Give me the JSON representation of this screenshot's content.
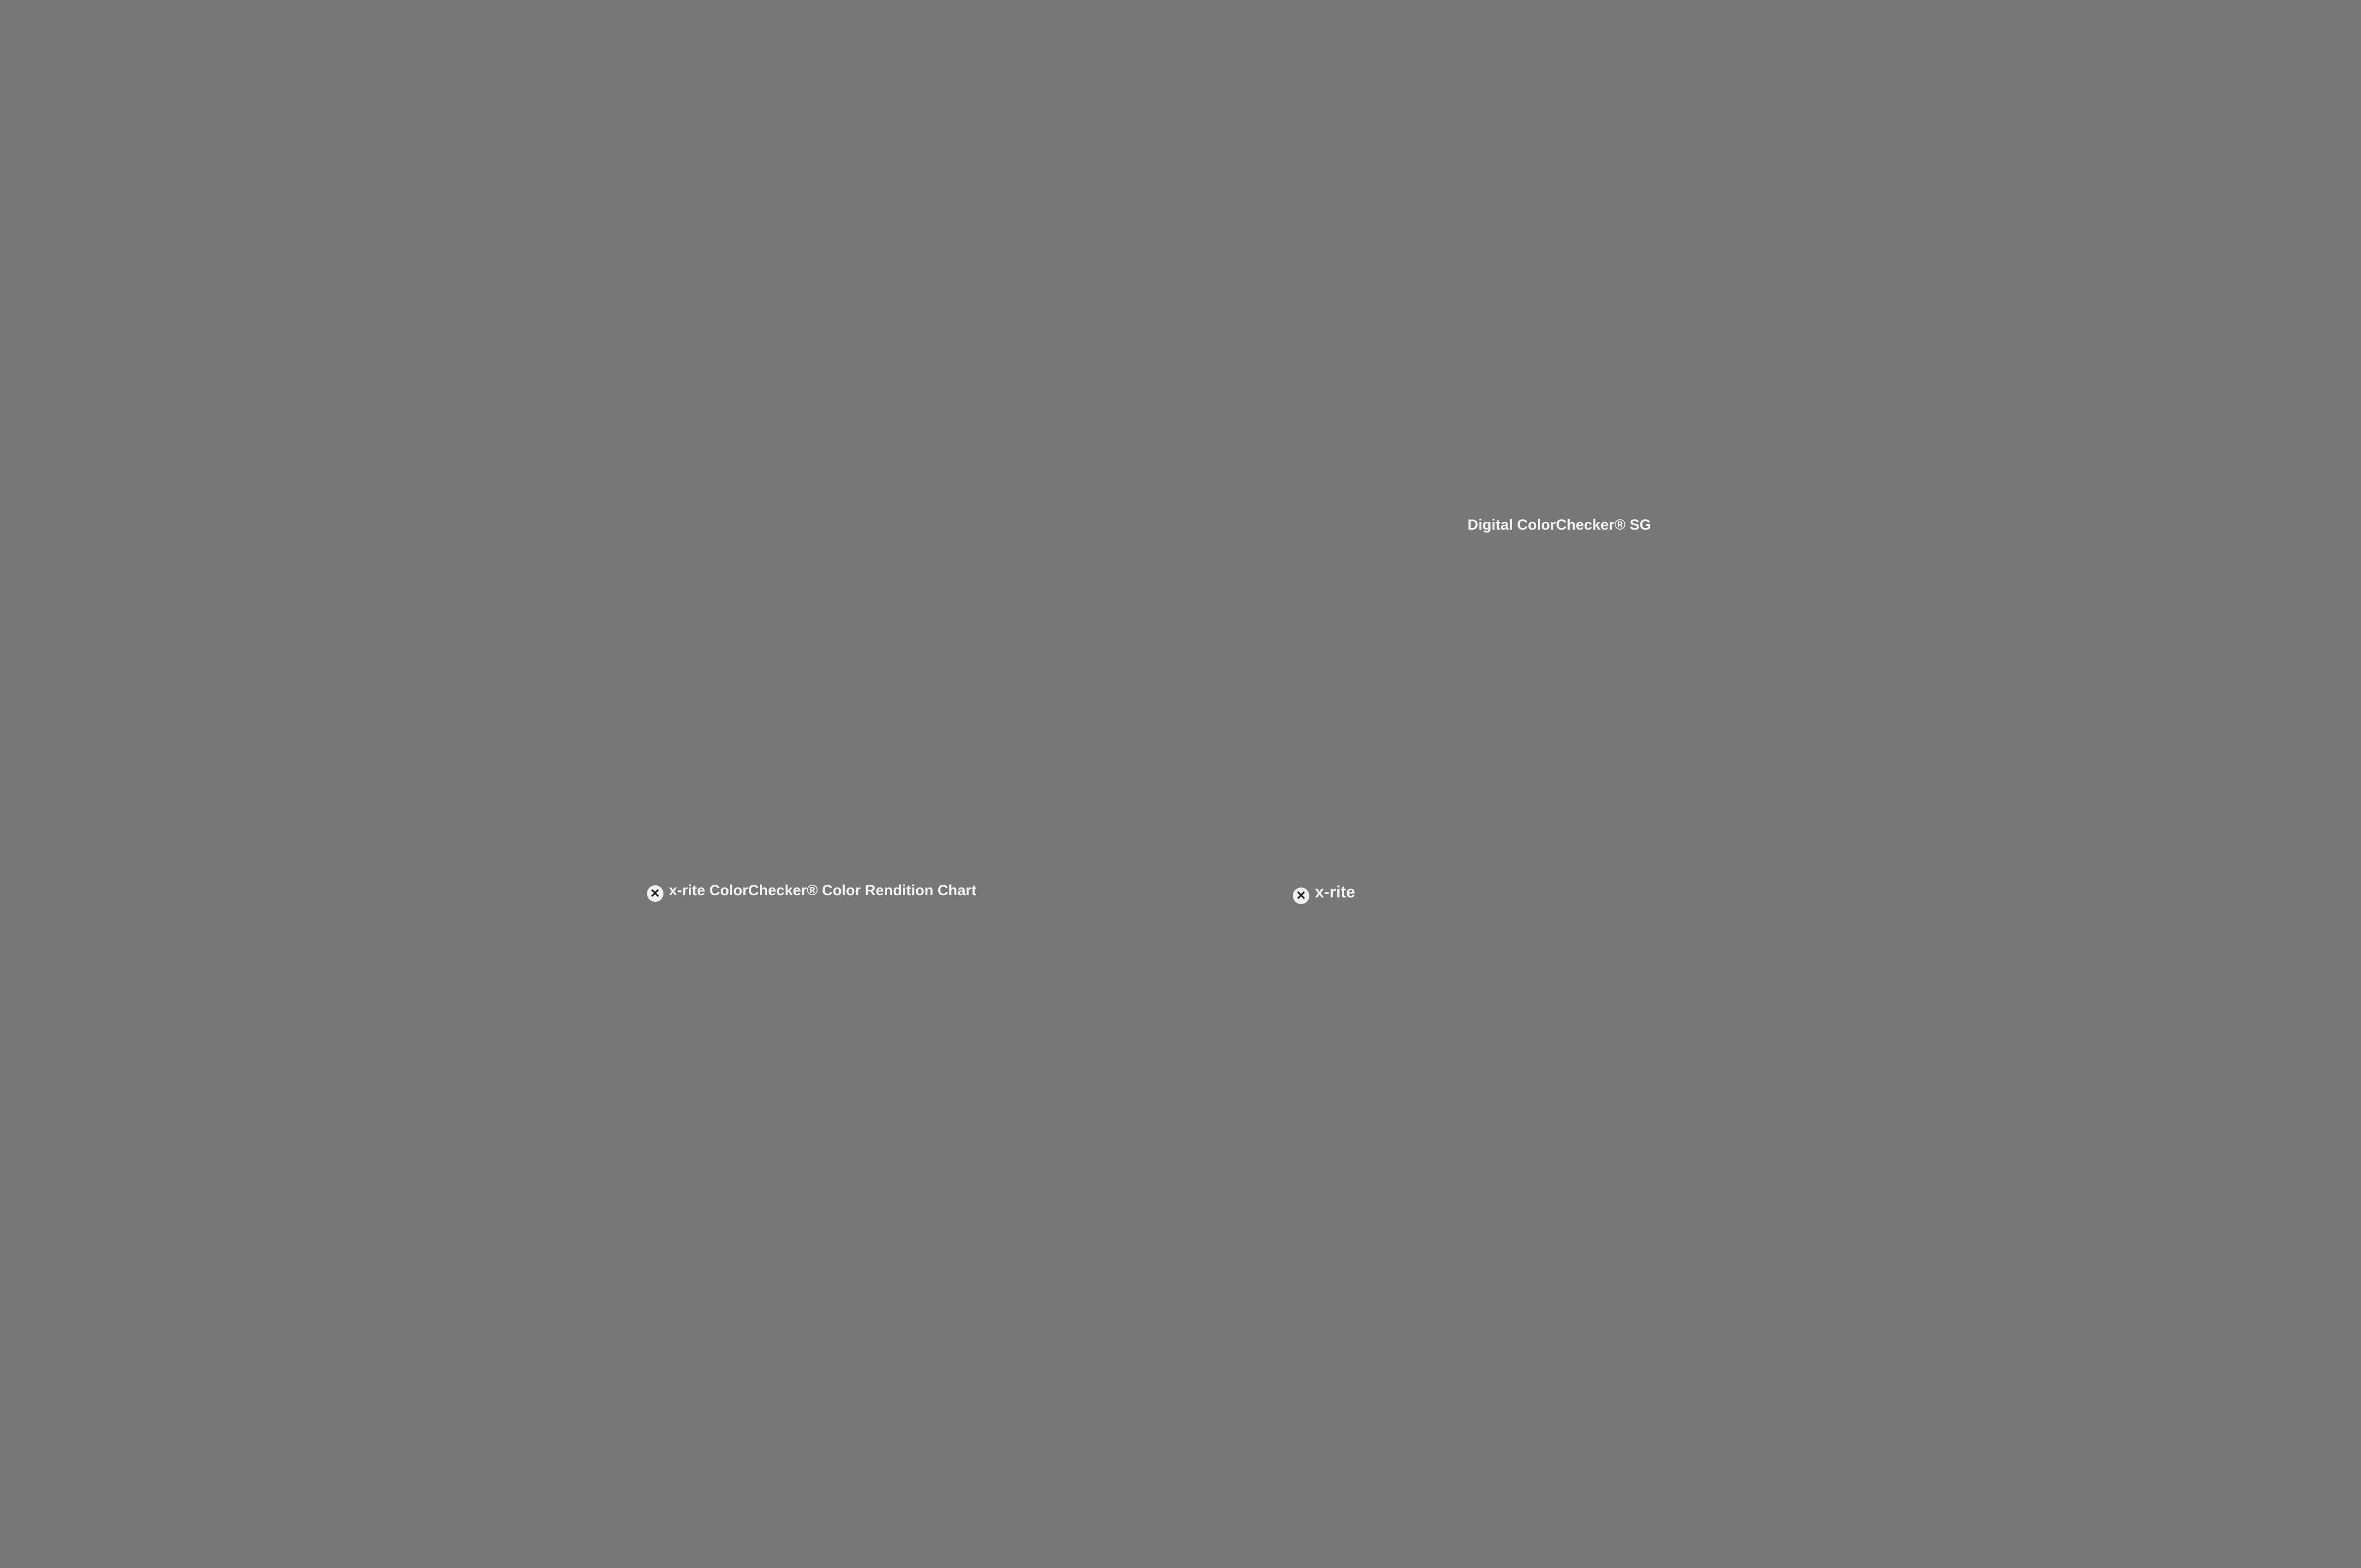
{
  "frame": {
    "wall": "#c9c9c7",
    "wall_edge": "#8e8e90",
    "red": "#c2191c",
    "white": "#eef0f1",
    "band_bg": "#8f9193",
    "line_heavy": "#17191b",
    "line_thin": "#43474b",
    "field": "#9ea0a3",
    "inner_line": "#42464a",
    "bar": "#cbced2",
    "tick": "#141618",
    "diag": "#3b3d40",
    "card": "#eceef0",
    "card_dark": "#1b1b1d",
    "usaf_ink": "#2f2f3c",
    "usaf_square": "#0e0e12",
    "fid_dark": "#16181a",
    "fid_light": "#f4f4f2",
    "ruler": "#c2ced2"
  },
  "usaf": {
    "top_labels": [
      "-2",
      "-1"
    ],
    "left_labels": [
      "2",
      "3",
      "4",
      "5",
      "6"
    ],
    "right_labels": [
      "1",
      "2",
      "3",
      "4",
      "5",
      "6"
    ],
    "bottom_labels": [
      "-2",
      "1"
    ],
    "tiny_labels": [
      "0",
      "1"
    ]
  },
  "classic_chart": {
    "logo_text": "x-rite",
    "title": "ColorChecker® Color Rendition Chart",
    "corner_mark": "+",
    "colors": [
      [
        "#7a4b36",
        "#dd9c84",
        "#5d88b8",
        "#4c5b22",
        "#9b9ce0",
        "#5fd0bb"
      ],
      [
        "#f07c1e",
        "#4668de",
        "#e05a6c",
        "#4f2a6c",
        "#a8c62c",
        "#eda613"
      ],
      [
        "#2b3bc2",
        "#2ba03e",
        "#d52b26",
        "#eecb00",
        "#dd59c0",
        "#0ba3d4"
      ],
      [
        "#f6f6f4",
        "#dcdcda",
        "#b8bab9",
        "#8f9291",
        "#575b5a",
        "#262827"
      ]
    ]
  },
  "sg_chart": {
    "title": "Digital ColorChecker® SG",
    "logo_text": "x-rite",
    "corner_mark": "+",
    "row_labels": [
      "1",
      "2",
      "3",
      "4",
      "5",
      "6",
      "7",
      "8",
      "9",
      "10"
    ],
    "col_labels": [
      "A",
      "B",
      "C",
      "D",
      "E",
      "F",
      "G",
      "H",
      "I",
      "J",
      "K",
      "L",
      "M",
      "N"
    ],
    "ruler_numbers": [
      "0",
      "1",
      "2",
      "3",
      "4",
      "5",
      "6"
    ],
    "ruler_unit": "mm",
    "colors": [
      [
        "#f4f4f2",
        "#a9abaa",
        "#1f2020",
        "#f4f4f2",
        "#a9abaa",
        "#1f2020",
        "#f4f4f2",
        "#a9abaa",
        "#1f2020",
        "#f4f4f2",
        "#a9abaa",
        "#1f2020",
        "#a9abaa",
        "#f4f4f2"
      ],
      [
        "#1f2020",
        "#ad2a72",
        "#3a2456",
        "#ccd7e8",
        "#84422e",
        "#dda08a",
        "#5e84be",
        "#43521e",
        "#8d96cf",
        "#66c6b8",
        "#ecc1a2",
        "#7e1c35",
        "#e23a6c",
        "#8b8d8c"
      ],
      [
        "#8b8d8c",
        "#c383c5",
        "#8a70c8",
        "#ecc6d2",
        "#e87d18",
        "#3f63c8",
        "#dd5560",
        "#5a2a6e",
        "#9fba2a",
        "#dea022",
        "#bfe0cd",
        "#d82a20",
        "#6b1c35",
        "#1f2020"
      ],
      [
        "#f4f4f2",
        "#7f2f9d",
        "#202a78",
        "#a2dcc8",
        "#2237b8",
        "#3d9b3f",
        "#c62b28",
        "#e2b000",
        "#dd4a9e",
        "#2698c0",
        "#ded2de",
        "#e393a8",
        "#d22740",
        "#f4f4f2"
      ],
      [
        "#1f2020",
        "#2a9ce0",
        "#62c5e4",
        "#f0c4ba",
        "#f2f2f0",
        "#d6d6d4",
        "#c0c2c0",
        "#a9abaa",
        "#8b8d8c",
        "#3a3b3b",
        "#c5e4ee",
        "#ef8f7d",
        "#fa4b33",
        "#8b8d8c"
      ],
      [
        "#8b8d8c",
        "#2cbdd2",
        "#15275e",
        "#d8e0a2",
        "#1f2020",
        "#555756",
        "#707271",
        "#8b8d8c",
        "#c0c2c0",
        "#eeeeec",
        "#d6d6d4",
        "#f98019",
        "#fcb900",
        "#1f2020"
      ],
      [
        "#f4f4f2",
        "#12453c",
        "#8fabe8",
        "#e59060",
        "#e8b18e",
        "#d8a87e",
        "#ab6d46",
        "#d8a88a",
        "#a96535",
        "#dfa077",
        "#8b8d8c",
        "#bcbe1e",
        "#e5c621",
        "#f4f4f2"
      ],
      [
        "#1f2020",
        "#3cc5b4",
        "#2fae9f",
        "#e7a88e",
        "#f0b296",
        "#e9c2a2",
        "#e7b1a0",
        "#cfa080",
        "#9c5526",
        "#e6a779",
        "#3a3b3b",
        "#bb9f1c",
        "#c5c32e",
        "#8b8d8c"
      ],
      [
        "#8b8d8c",
        "#3c2a12",
        "#5cc794",
        "#2aa25c",
        "#0f4527",
        "#54c8a4",
        "#83ca5a",
        "#31a833",
        "#2bb02a",
        "#cd9140",
        "#a3a321",
        "#aec922",
        "#4a2810",
        "#1f2020"
      ],
      [
        "#f4f4f2",
        "#a9abaa",
        "#1f2020",
        "#f4f4f2",
        "#a9abaa",
        "#242525",
        "#8b8d8c",
        "#a9abaa",
        "#1f2020",
        "#f4f4f2",
        "#c0c2c0",
        "#1f2020",
        "#a9abaa",
        "#f4f4f2"
      ]
    ]
  },
  "stars": [
    {
      "id": "top-left",
      "color_a": "#d63a2a",
      "color_b": "#1c1216",
      "center": "#8c2a1e"
    },
    {
      "id": "top-right",
      "color_a": "#3cc14c",
      "color_b": "#0a1c0e",
      "center": "#1f7a2a"
    },
    {
      "id": "mid-left",
      "color_a": "#e04830",
      "color_b": "#58b848",
      "center": "#c08828"
    },
    {
      "id": "mid-right",
      "color_a": "#3c55c8",
      "color_b": "#0a0e30",
      "center": "#2034a0"
    },
    {
      "id": "bottom-left",
      "color_a": "#44bd82",
      "color_b": "#3263c6",
      "center": "#2f9aa8"
    },
    {
      "id": "bottom-right",
      "color_a": "#d84040",
      "color_b": "#4050c8",
      "center": "#b03a88"
    }
  ],
  "wedge": {
    "background": "#d2d3d5",
    "strip_bg": "#efeff1",
    "bar_ink": "#1a1a1c",
    "sweep_ink": "#5e6066",
    "end_block": "#121212",
    "grayscale_steps": [
      "#e2e2e2",
      "#ececec",
      "#e6e6e6",
      "#dedede",
      "#d6d6d6",
      "#cecece",
      "#c6c6c6",
      "#bebebe",
      "#b6b6b6",
      "#aeaeae",
      "#a6a6a6",
      "#9e9e9e",
      "#949494",
      "#8c8c8c",
      "#848484",
      "#7a7a7a",
      "#727272",
      "#6a6a6a",
      "#606060",
      "#585858"
    ]
  },
  "photo": {
    "bg": "#37476e",
    "bg_light": "#7286ae",
    "bg_dark": "#232d4e",
    "blouse": "#ead98e",
    "vest": "#7e2330",
    "skin1": "#ecd0c0",
    "hair1": "#d9c08c",
    "flower1": "#c04858",
    "flower2": "#e8a0a8",
    "leaf": "#7a8a3a",
    "kimono": "#2f6cc4",
    "skin2": "#e8cdb2",
    "hair2": "#151826",
    "flower_white": "#ede8da",
    "violin": "#7a4018",
    "robe": "#1d3356",
    "skin3": "#9a6a42",
    "wrap": "#e9bc2c",
    "necklace": "#e8c428",
    "cello": "#b5742c",
    "cello_dark": "#5e3410",
    "strings": "#1c1c20"
  }
}
